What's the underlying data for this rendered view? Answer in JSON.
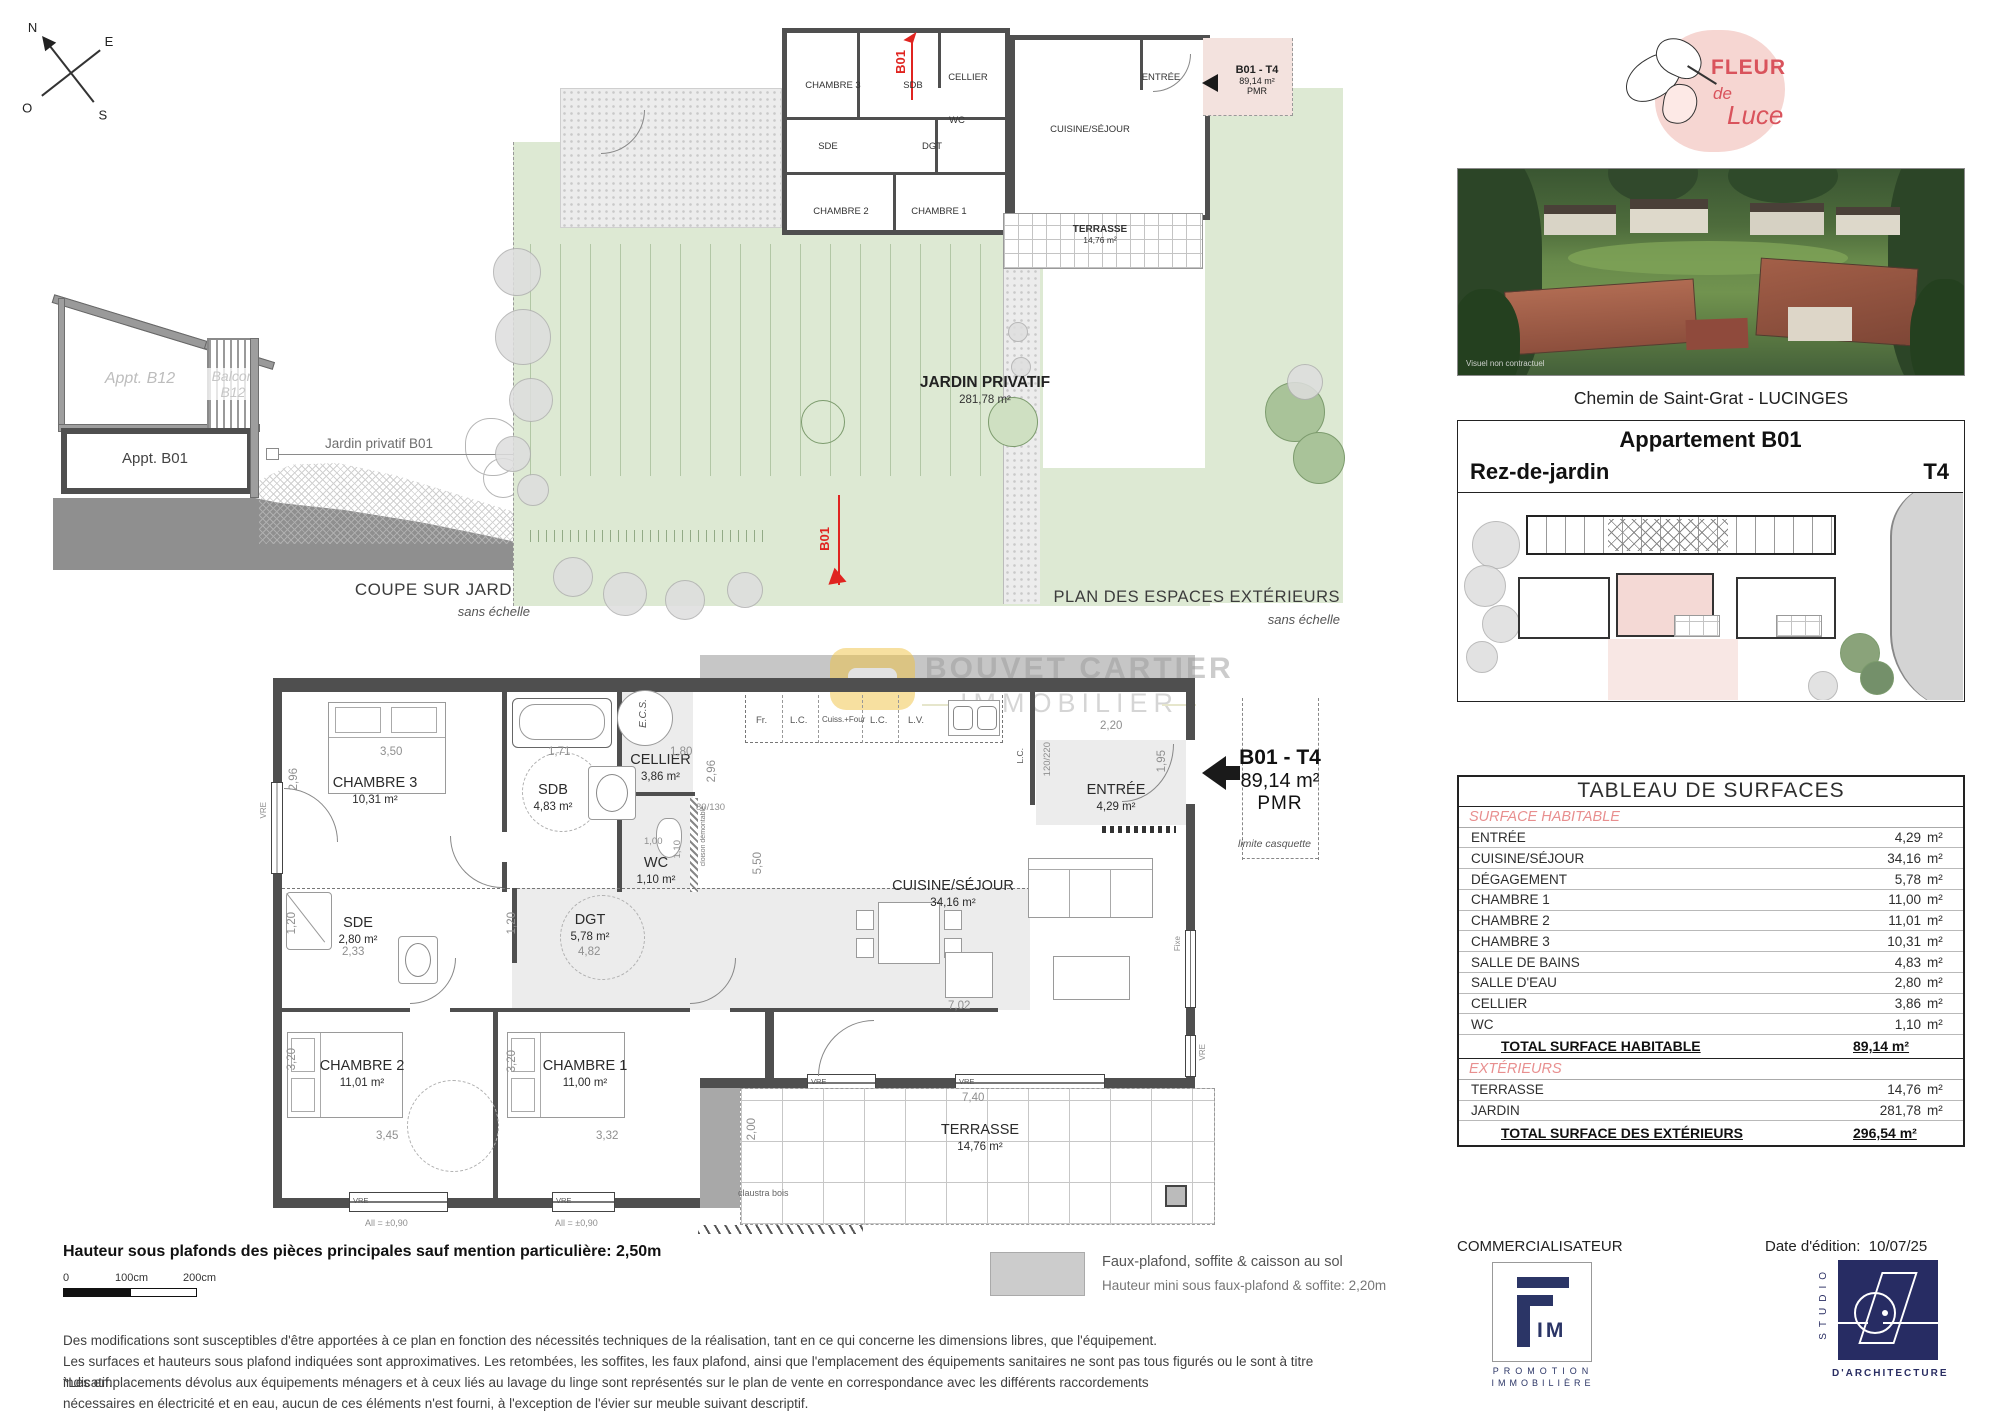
{
  "compass": {
    "n": "N",
    "e": "E",
    "s": "S",
    "o": "O"
  },
  "coupe": {
    "appt_b12": "Appt. B12",
    "balcon_l1": "Balcon",
    "balcon_l2": "B12",
    "appt_b01": "Appt. B01",
    "jardin_arrow": "Jardin privatif B01",
    "caption": "COUPE SUR JARDIN",
    "caption_sub": "sans échelle"
  },
  "exterior_plan": {
    "caption": "PLAN DES ESPACES EXTÉRIEURS",
    "caption_sub": "sans échelle",
    "jardin_name": "JARDIN PRIVATIF",
    "jardin_area": "281,78 m²",
    "terrasse_name": "TERRASSE",
    "terrasse_area": "14,76 m²",
    "marker": "B01",
    "tag_line1": "B01 - T4",
    "tag_line2": "89,14 m²",
    "tag_line3": "PMR",
    "rooms": {
      "chambre3": "CHAMBRE 3",
      "sdb": "SDB",
      "cellier": "CELLIER",
      "wc": "WC",
      "sde": "SDE",
      "dgt": "DGT",
      "chambre2": "CHAMBRE 2",
      "chambre1": "CHAMBRE 1",
      "entree": "ENTRÉE",
      "cuisine": "CUISINE/SÉJOUR"
    }
  },
  "main_plan": {
    "rooms": {
      "chambre3": {
        "name": "CHAMBRE 3",
        "area": "10,31 m²"
      },
      "sdb": {
        "name": "SDB",
        "area": "4,83 m²"
      },
      "cellier": {
        "name": "CELLIER",
        "area": "3,86 m²"
      },
      "wc": {
        "name": "WC",
        "area": "1,10 m²"
      },
      "sde": {
        "name": "SDE",
        "area": "2,80 m²"
      },
      "dgt": {
        "name": "DGT",
        "area": "5,78 m²"
      },
      "chambre2": {
        "name": "CHAMBRE 2",
        "area": "11,01 m²"
      },
      "chambre1": {
        "name": "CHAMBRE 1",
        "area": "11,00 m²"
      },
      "cuisine": {
        "name": "CUISINE/SÉJOUR",
        "area": "34,16 m²"
      },
      "entree": {
        "name": "ENTRÉE",
        "area": "4,29 m²"
      },
      "terrasse": {
        "name": "TERRASSE",
        "area": "14,76 m²"
      }
    },
    "tag": {
      "line1": "B01 - T4",
      "line2": "89,14 m²",
      "line3": "PMR"
    },
    "dims": {
      "chambre3_w": "3,50",
      "chambre3_h": "2,96",
      "sdb_w": "1,71",
      "cellier_w": "1,80",
      "cellier_h": "2,96",
      "pass": "80/130",
      "wc_w": "1,00",
      "wc_h": "1,10",
      "sde_w": "2,33",
      "sde_h": "1,20",
      "dgt_w": "4,82",
      "dgt_h": "1,20",
      "cuisine_h": "5,50",
      "cuisine_w": "7,02",
      "entree_w": "2,20",
      "bay": "120/220",
      "entree_h": "1,95",
      "chambre2_w": "3,45",
      "chambre2_h": "3,20",
      "chambre1_w": "3,32",
      "chambre1_h": "3,20",
      "terrasse_w": "7,40",
      "terrasse_h": "2,00"
    },
    "appliances": {
      "fr": "Fr.",
      "lc": "L.C.",
      "cuiss": "Cuiss.+Four",
      "lv": "L.V.",
      "ecs": "E.C.S."
    },
    "annotations": {
      "vre": "VRE",
      "fixe": "Fixe",
      "allege": "All = ±0,90",
      "seuil": "Seuil = ± 0,00",
      "claustra": "claustra bois",
      "cloison": "cloison démontable",
      "limite": "limite casquette"
    },
    "watermark": {
      "line1": "BOUVET CARTIER",
      "line2": "IMMOBILIER"
    }
  },
  "brand": {
    "logo_word1": "FLEUR",
    "logo_word2": "de",
    "logo_word3": "Luce",
    "photo_note": "Visuel non contractuel",
    "address": "Chemin de Saint-Grat - LUCINGES"
  },
  "apartment_card": {
    "title": "Appartement B01",
    "level": "Rez-de-jardin",
    "type": "T4"
  },
  "surface_table": {
    "title": "TABLEAU DE SURFACES",
    "unit": "m²",
    "habitable_section": "SURFACE HABITABLE",
    "habitable_rows": [
      {
        "label": "ENTRÉE",
        "value": "4,29"
      },
      {
        "label": "CUISINE/SÉJOUR",
        "value": "34,16"
      },
      {
        "label": "DÉGAGEMENT",
        "value": "5,78"
      },
      {
        "label": "CHAMBRE 1",
        "value": "11,00"
      },
      {
        "label": "CHAMBRE 2",
        "value": "11,01"
      },
      {
        "label": "CHAMBRE 3",
        "value": "10,31"
      },
      {
        "label": "SALLE DE BAINS",
        "value": "4,83"
      },
      {
        "label": "SALLE D'EAU",
        "value": "2,80"
      },
      {
        "label": "CELLIER",
        "value": "3,86"
      },
      {
        "label": "WC",
        "value": "1,10"
      }
    ],
    "habitable_total_label": "TOTAL SURFACE HABITABLE",
    "habitable_total_value": "89,14 m²",
    "ext_section": "EXTÉRIEURS",
    "ext_rows": [
      {
        "label": "TERRASSE",
        "value": "14,76"
      },
      {
        "label": "JARDIN",
        "value": "281,78"
      }
    ],
    "ext_total_label": "TOTAL SURFACE DES EXTÉRIEURS",
    "ext_total_value": "296,54 m²"
  },
  "footer": {
    "height_note": "Hauteur sous plafonds des pièces principales sauf mention particulière: 2,50m",
    "scale_ticks": [
      "0",
      "100cm",
      "200cm"
    ],
    "legend_line1": "Faux-plafond, soffite & caisson au sol",
    "legend_line2": "Hauteur mini sous faux-plafond & soffite: 2,20m",
    "disclaimer": [
      "Des modifications sont susceptibles d'être apportées à ce plan en fonction des nécessités techniques de la réalisation, tant en ce qui concerne les dimensions libres, que l'équipement.",
      "Les surfaces et hauteurs sous plafond indiquées sont approximatives. Les retombées, les soffites, les faux plafond, ainsi que l'emplacement des équipements sanitaires ne sont pas tous figurés ou le sont à titre indicatif.",
      "*Les emplacements dévolus aux équipements ménagers et à ceux liés au lavage du linge sont représentés sur le plan de vente en correspondance avec les différents raccordements",
      "nécessaires en électricité et en eau, aucun de ces éléments n'est fourni, à l'exception de l'évier sur meuble suivant descriptif."
    ],
    "commercialisateur": "COMMERCIALISATEUR",
    "date_label": "Date d'édition:",
    "date_value": "10/07/25",
    "fim_mark": "IM",
    "fim_line1": "PROMOTION",
    "fim_line2": "IMMOBILIÈRE",
    "studio_vertical": "STUDIO",
    "studio_sub": "D'ARCHITECTURE"
  }
}
